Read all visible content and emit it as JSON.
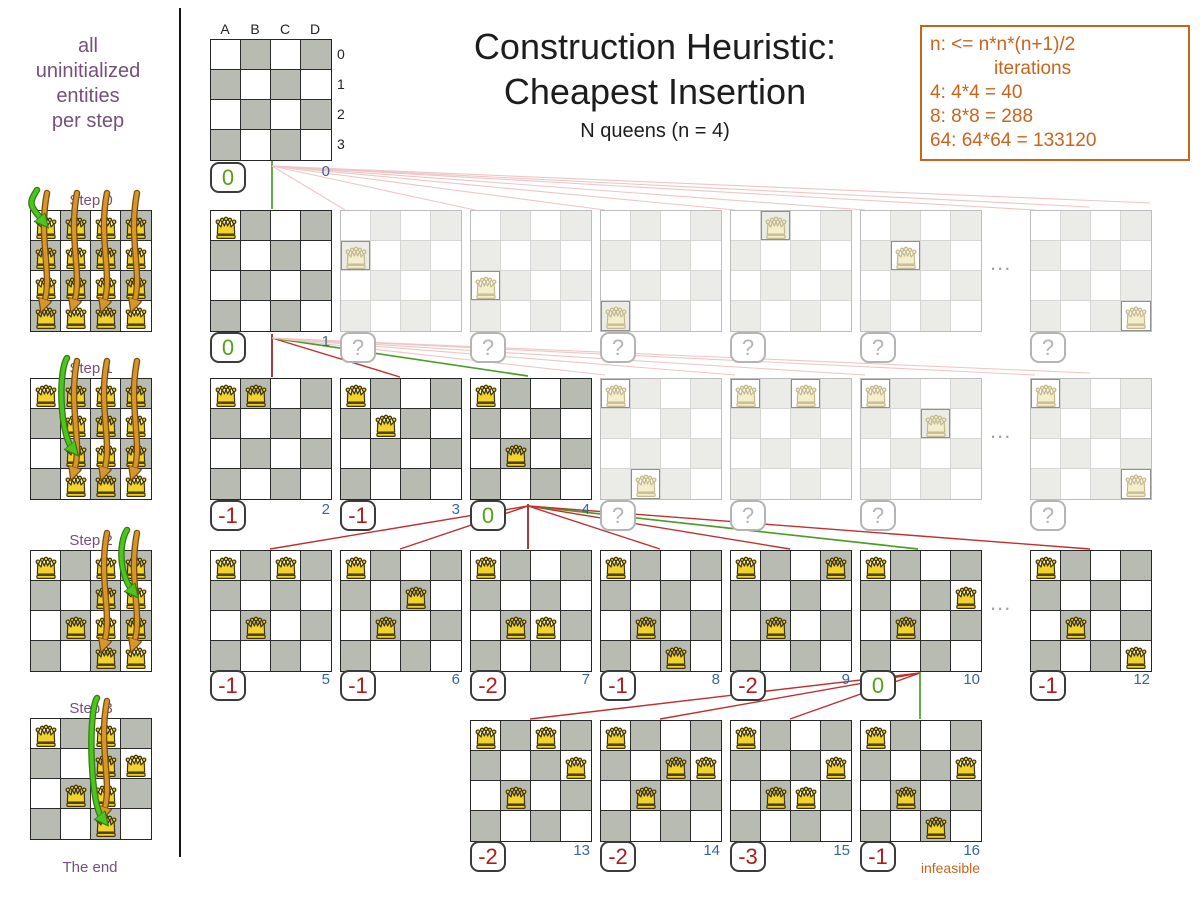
{
  "colors": {
    "purple": "#75507b",
    "orange": "#c9641c",
    "blue": "#3465a4",
    "green": "#55a018",
    "red": "#b01b1b",
    "line_green": "#4a9e28",
    "line_red": "#c03030",
    "line_darkred": "#8f1a1a",
    "line_pink": "#eec6c6",
    "cell_dark": "#b7bbb1",
    "cell_faded": "#ebebe8",
    "queen_gold": "#f2d22e",
    "queen_outline": "#403300"
  },
  "title": {
    "line1": "Construction Heuristic:",
    "line2": "Cheapest Insertion",
    "subtitle": "N queens (n = 4)"
  },
  "info_box": {
    "lines": [
      "n: <= n*n*(n+1)/2",
      "iterations",
      "4: 4*4 = 40",
      "8: 8*8 = 288",
      "64: 64*64 = 133120"
    ]
  },
  "sidebar": {
    "caption_lines": [
      "all",
      "uninitialized",
      "entities",
      "per step"
    ],
    "end_label": "The end",
    "steps": [
      {
        "label": "Step 0",
        "y": 210,
        "fixed": [],
        "candidate_cols": [
          "A",
          "B",
          "C",
          "D"
        ],
        "selected": "A0"
      },
      {
        "label": "Step 1",
        "y": 378,
        "fixed": [
          "A0"
        ],
        "candidate_cols": [
          "B",
          "C",
          "D"
        ],
        "selected": "B2"
      },
      {
        "label": "Step 2",
        "y": 550,
        "fixed": [
          "A0",
          "B2"
        ],
        "candidate_cols": [
          "C",
          "D"
        ],
        "selected": "D1"
      },
      {
        "label": "Step 3",
        "y": 718,
        "fixed": [
          "A0",
          "D1",
          "B2"
        ],
        "candidate_cols": [
          "C"
        ],
        "selected": "C3"
      }
    ]
  },
  "board_labels": {
    "cols": [
      "A",
      "B",
      "C",
      "D"
    ],
    "rows": [
      "0",
      "1",
      "2",
      "3"
    ]
  },
  "unknown_score": "?",
  "ellipsis": "...",
  "infeasible_label": "infeasible",
  "tree": {
    "rows": [
      {
        "y": 39,
        "badge_y": 162,
        "boards": [
          {
            "x": 210,
            "queens": [],
            "score": "0",
            "good": true,
            "iter": "0",
            "labels": true
          }
        ]
      },
      {
        "y": 210,
        "badge_y": 332,
        "ellipsis_x": 990,
        "boards": [
          {
            "x": 210,
            "queens": [
              "A0"
            ],
            "score": "0",
            "good": true,
            "iter": "1"
          },
          {
            "x": 340,
            "queens": [
              "A1"
            ],
            "faded": true
          },
          {
            "x": 470,
            "queens": [
              "A2"
            ],
            "faded": true
          },
          {
            "x": 600,
            "queens": [
              "A3"
            ],
            "faded": true
          },
          {
            "x": 730,
            "queens": [
              "B0"
            ],
            "faded": true
          },
          {
            "x": 860,
            "queens": [
              "B1"
            ],
            "faded": true
          },
          {
            "x": 1030,
            "queens": [
              "D3"
            ],
            "faded": true
          }
        ]
      },
      {
        "y": 378,
        "badge_y": 500,
        "ellipsis_x": 990,
        "boards": [
          {
            "x": 210,
            "queens": [
              "A0",
              "B0"
            ],
            "score": "-1",
            "iter": "2"
          },
          {
            "x": 340,
            "queens": [
              "A0",
              "B1"
            ],
            "score": "-1",
            "iter": "3"
          },
          {
            "x": 470,
            "queens": [
              "A0",
              "B2"
            ],
            "score": "0",
            "good": true,
            "iter": "4"
          },
          {
            "x": 600,
            "queens": [
              "A0",
              "B3"
            ],
            "faded": true
          },
          {
            "x": 730,
            "queens": [
              "A0",
              "C0"
            ],
            "faded": true
          },
          {
            "x": 860,
            "queens": [
              "A0",
              "C1"
            ],
            "faded": true
          },
          {
            "x": 1030,
            "queens": [
              "A0",
              "D3"
            ],
            "faded": true
          }
        ]
      },
      {
        "y": 550,
        "badge_y": 670,
        "ellipsis_x": 990,
        "boards": [
          {
            "x": 210,
            "queens": [
              "A0",
              "B2",
              "C0"
            ],
            "score": "-1",
            "iter": "5"
          },
          {
            "x": 340,
            "queens": [
              "A0",
              "B2",
              "C1"
            ],
            "score": "-1",
            "iter": "6"
          },
          {
            "x": 470,
            "queens": [
              "A0",
              "B2",
              "C2"
            ],
            "score": "-2",
            "iter": "7"
          },
          {
            "x": 600,
            "queens": [
              "A0",
              "B2",
              "C3"
            ],
            "score": "-1",
            "iter": "8"
          },
          {
            "x": 730,
            "queens": [
              "A0",
              "B2",
              "D0"
            ],
            "score": "-2",
            "iter": "9"
          },
          {
            "x": 860,
            "queens": [
              "A0",
              "B2",
              "D1"
            ],
            "score": "0",
            "good": true,
            "iter": "10"
          },
          {
            "x": 1030,
            "queens": [
              "A0",
              "B2",
              "D3"
            ],
            "score": "-1",
            "iter": "12"
          }
        ]
      },
      {
        "y": 720,
        "badge_y": 841,
        "boards": [
          {
            "x": 470,
            "queens": [
              "A0",
              "C0",
              "D1",
              "B2"
            ],
            "score": "-2",
            "iter": "13"
          },
          {
            "x": 600,
            "queens": [
              "A0",
              "C1",
              "D1",
              "B2"
            ],
            "score": "-2",
            "iter": "14"
          },
          {
            "x": 730,
            "queens": [
              "A0",
              "C2",
              "B2",
              "D1"
            ],
            "score": "-3",
            "iter": "15"
          },
          {
            "x": 860,
            "queens": [
              "A0",
              "D1",
              "B2",
              "C3"
            ],
            "score": "-1",
            "iter": "16",
            "note": "infeasible"
          }
        ]
      }
    ]
  },
  "connectors": [
    {
      "k": "green",
      "x1": 272,
      "y1": 160,
      "x2": 272,
      "y2": 209
    },
    {
      "k": "pink",
      "x1": 272,
      "y1": 166,
      "x2": 345,
      "y2": 210
    },
    {
      "k": "pink",
      "x1": 272,
      "y1": 166,
      "x2": 475,
      "y2": 210
    },
    {
      "k": "pink",
      "x1": 272,
      "y1": 166,
      "x2": 605,
      "y2": 210
    },
    {
      "k": "pink",
      "x1": 272,
      "y1": 166,
      "x2": 735,
      "y2": 210
    },
    {
      "k": "pink",
      "x1": 272,
      "y1": 166,
      "x2": 865,
      "y2": 210
    },
    {
      "k": "pink",
      "x1": 272,
      "y1": 166,
      "x2": 1035,
      "y2": 210
    },
    {
      "k": "pink",
      "x1": 272,
      "y1": 166,
      "x2": 1090,
      "y2": 207
    },
    {
      "k": "pink",
      "x1": 272,
      "y1": 166,
      "x2": 1150,
      "y2": 203
    },
    {
      "k": "darkred",
      "x1": 272,
      "y1": 334,
      "x2": 272,
      "y2": 377
    },
    {
      "k": "red",
      "x1": 272,
      "y1": 338,
      "x2": 400,
      "y2": 377
    },
    {
      "k": "green",
      "x1": 272,
      "y1": 338,
      "x2": 528,
      "y2": 376
    },
    {
      "k": "pink",
      "x1": 272,
      "y1": 338,
      "x2": 605,
      "y2": 375
    },
    {
      "k": "pink",
      "x1": 272,
      "y1": 338,
      "x2": 735,
      "y2": 375
    },
    {
      "k": "pink",
      "x1": 272,
      "y1": 338,
      "x2": 865,
      "y2": 375
    },
    {
      "k": "pink",
      "x1": 272,
      "y1": 338,
      "x2": 1035,
      "y2": 375
    },
    {
      "k": "pink",
      "x1": 272,
      "y1": 338,
      "x2": 1090,
      "y2": 373
    },
    {
      "k": "darkred",
      "x1": 528,
      "y1": 504,
      "x2": 528,
      "y2": 549
    },
    {
      "k": "red",
      "x1": 528,
      "y1": 506,
      "x2": 270,
      "y2": 549
    },
    {
      "k": "red",
      "x1": 528,
      "y1": 506,
      "x2": 400,
      "y2": 549
    },
    {
      "k": "red",
      "x1": 528,
      "y1": 506,
      "x2": 660,
      "y2": 549
    },
    {
      "k": "red",
      "x1": 528,
      "y1": 506,
      "x2": 790,
      "y2": 549
    },
    {
      "k": "green",
      "x1": 528,
      "y1": 506,
      "x2": 918,
      "y2": 549
    },
    {
      "k": "red",
      "x1": 528,
      "y1": 506,
      "x2": 1090,
      "y2": 549
    },
    {
      "k": "red",
      "x1": 920,
      "y1": 673,
      "x2": 530,
      "y2": 719
    },
    {
      "k": "red",
      "x1": 920,
      "y1": 673,
      "x2": 660,
      "y2": 719
    },
    {
      "k": "red",
      "x1": 920,
      "y1": 673,
      "x2": 790,
      "y2": 719
    },
    {
      "k": "green",
      "x1": 920,
      "y1": 671,
      "x2": 920,
      "y2": 719
    }
  ]
}
